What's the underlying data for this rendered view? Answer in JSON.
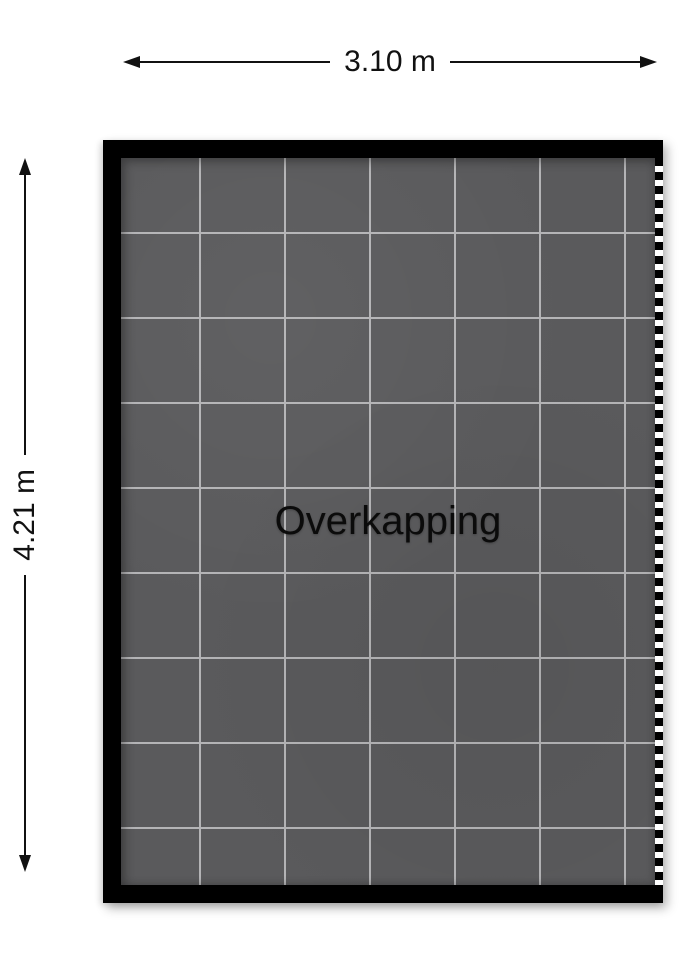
{
  "room": {
    "label": "Overkapping"
  },
  "dimensions": {
    "width_label": "3.10 m",
    "height_label": "4.21 m"
  },
  "colors": {
    "wall": "#000000",
    "floor": "#5a5a5c",
    "grout": "#b4b4b6",
    "dimension": "#111111",
    "background": "#ffffff"
  }
}
